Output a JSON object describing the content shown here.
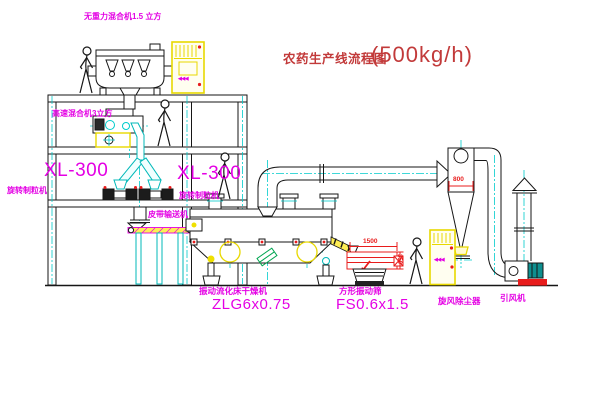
{
  "title": {
    "text": "农药生产线流程图",
    "capacity": "(500kg/h)"
  },
  "labels": {
    "top_mixer": "无重力混合机1.5 立方",
    "high_speed_mixer": "高速混合机3立方",
    "granulator_left_model": "XL-300",
    "granulator_left_name": "旋转制粒机",
    "granulator_right_model": "XL-300",
    "granulator_right_name": "旋转制粒机",
    "belt_conveyor": "皮带输送机",
    "dryer_name": "振动流化床干燥机",
    "dryer_model": "ZLG6x0.75",
    "sieve_name": "方形振动筛",
    "sieve_model": "FS0.6x1.5",
    "cyclone": "旋风除尘器",
    "fan": "引风机"
  },
  "dimensions": {
    "sieve_length": "1500",
    "sieve_height": "350",
    "cyclone_diameter": "800"
  },
  "cabinet_glyph": "◀◀◀",
  "colors": {
    "label_magenta": "#e400e4",
    "title_red": "#c23a3a",
    "dimension_red": "#e81c1c",
    "centerline_cyan": "#00cccc",
    "cabinet_yellow": "#e8d800",
    "hatch_yellow": "#ffee55",
    "green_accent": "#00a550",
    "line_black": "#161616"
  }
}
